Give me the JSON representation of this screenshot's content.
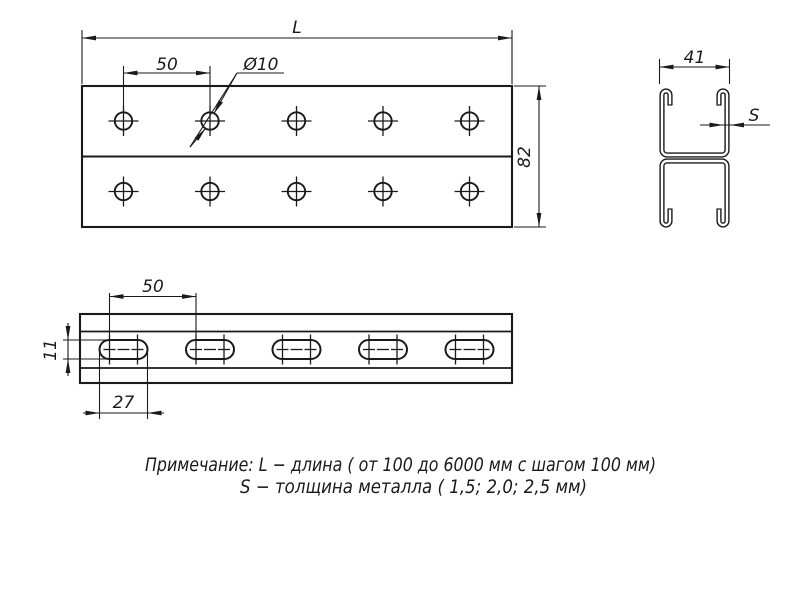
{
  "labels": {
    "plan": {
      "length": "L",
      "hole_spacing": "50",
      "hole_diameter": "Ø10",
      "height": "82"
    },
    "section": {
      "width": "41",
      "thickness": "S"
    },
    "side": {
      "slot_spacing": "50",
      "slot_height": "11",
      "slot_length": "27"
    }
  },
  "note": {
    "line1": "Примечание: L − длина ( от 100 до 6000 мм с шагом 100 мм)",
    "line2": "S − толщина металла ( 1,5; 2,0; 2,5 мм)"
  },
  "colors": {
    "line": "#1a1a1a",
    "background": "#ffffff"
  }
}
